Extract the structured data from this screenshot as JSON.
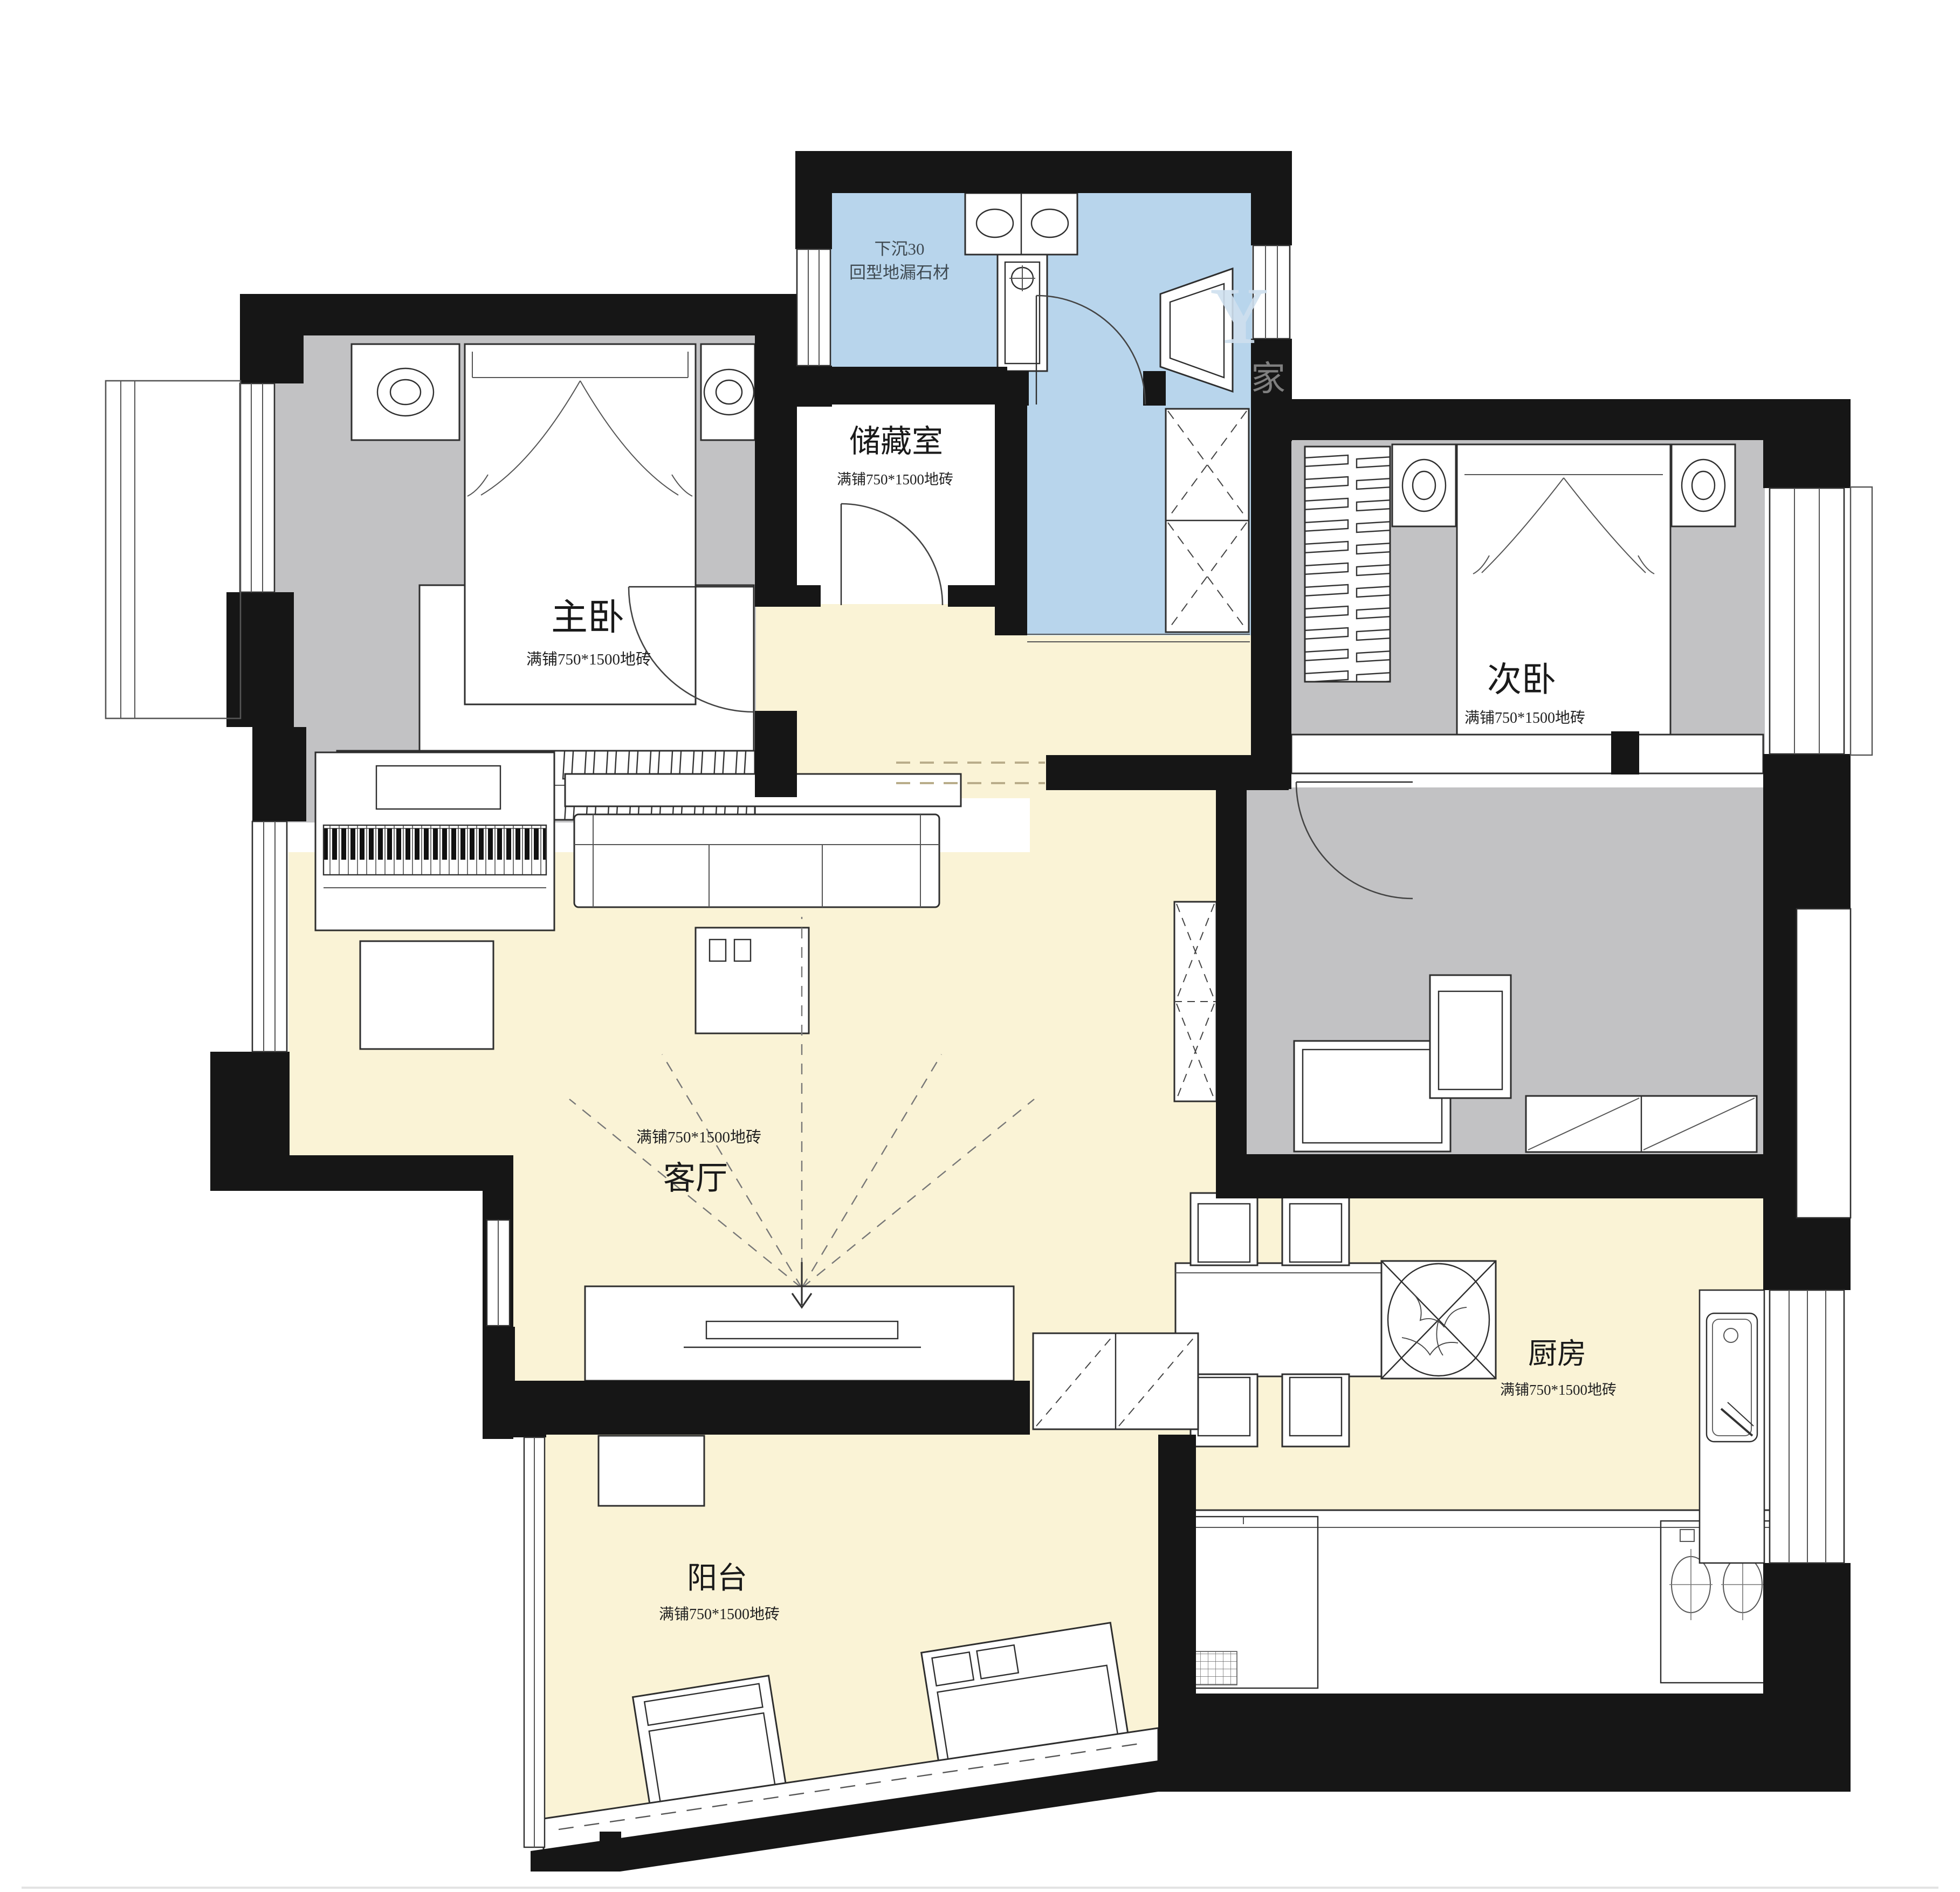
{
  "palette": {
    "wall": "#161616",
    "bedroom_floor": "#c2c2c4",
    "living_floor": "#faf3d6",
    "bath_floor": "#b8d5ec",
    "furniture_fill": "#ffffff",
    "line": "#2e2e2e"
  },
  "rooms": {
    "master": {
      "name": "主卧",
      "tile": "满铺750*1500地砖"
    },
    "storage": {
      "name": "储藏室",
      "tile": "满铺750*1500地砖"
    },
    "second": {
      "name": "次卧",
      "tile": "满铺750*1500地砖"
    },
    "living": {
      "name": "客厅",
      "tile": "满铺750*1500地砖"
    },
    "kitchen": {
      "name": "厨房",
      "tile": "满铺750*1500地砖"
    },
    "balcony": {
      "name": "阳台",
      "tile": "满铺750*1500地砖"
    }
  },
  "annotations": {
    "bath_line1": "下沉30",
    "bath_line2": "回型地漏石材"
  },
  "watermark": {
    "letter": "Y",
    "char": "家"
  }
}
